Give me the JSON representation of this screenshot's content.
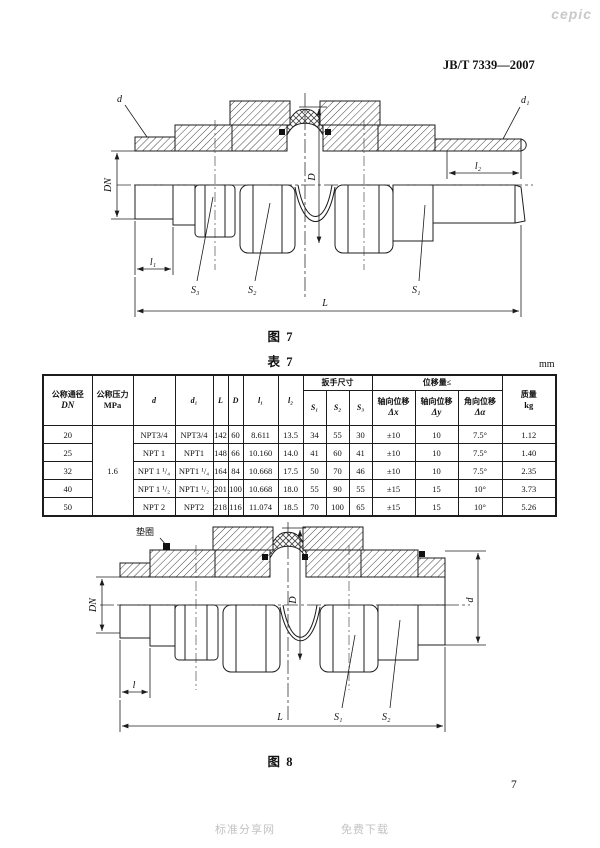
{
  "page": {
    "watermark": "cepic",
    "doc_number": "JB/T 7339—2007",
    "unit": "mm",
    "page_number": "7",
    "footer_left": "标准分享网",
    "footer_right": "免费下载"
  },
  "fig7": {
    "caption": "图  7",
    "labels": {
      "d": "d",
      "d1": "d₁",
      "dn": "DN",
      "D": "D",
      "l1": "l₁",
      "l2": "l₂",
      "s1": "S₁",
      "s2": "S₂",
      "s3": "S₃",
      "L": "L"
    }
  },
  "table7": {
    "caption": "表  7",
    "header": {
      "dn_zh": "公称通径",
      "dn_en": "DN",
      "pressure_zh": "公称压力",
      "pressure_en": "MPa",
      "d": "d",
      "d1": "d₁",
      "L": "L",
      "D": "D",
      "l1": "l₁",
      "l2": "l₂",
      "wrench_group": "扳手尺寸",
      "s1": "S₁",
      "s2": "S₂",
      "s3": "S₃",
      "disp_group": "位移量≤",
      "dx_zh": "轴向位移",
      "dx_sym": "Δx",
      "dy_zh": "轴向位移",
      "dy_sym": "Δy",
      "da_zh": "角向位移",
      "da_sym": "Δα",
      "mass_zh": "质量",
      "mass_en": "kg"
    },
    "pressure_value": "1.6",
    "rows": [
      {
        "dn": "20",
        "d": "NPT3/4",
        "d1": "NPT3/4",
        "L": "142",
        "D": "60",
        "l1": "8.611",
        "l2": "13.5",
        "s1": "34",
        "s2": "55",
        "s3": "30",
        "dx": "±10",
        "dy": "10",
        "da": "7.5°",
        "mass": "1.12"
      },
      {
        "dn": "25",
        "d": "NPT 1",
        "d1": "NPT1",
        "L": "148",
        "D": "66",
        "l1": "10.160",
        "l2": "14.0",
        "s1": "41",
        "s2": "60",
        "s3": "41",
        "dx": "±10",
        "dy": "10",
        "da": "7.5°",
        "mass": "1.40"
      },
      {
        "dn": "32",
        "d": "NPT 1 ¹/₄",
        "d1": "NPT1 ¹/₄",
        "L": "164",
        "D": "84",
        "l1": "10.668",
        "l2": "17.5",
        "s1": "50",
        "s2": "70",
        "s3": "46",
        "dx": "±10",
        "dy": "10",
        "da": "7.5°",
        "mass": "2.35"
      },
      {
        "dn": "40",
        "d": "NPT 1 ¹/₂",
        "d1": "NPT1 ¹/₂",
        "L": "201",
        "D": "100",
        "l1": "10.668",
        "l2": "18.0",
        "s1": "55",
        "s2": "90",
        "s3": "55",
        "dx": "±15",
        "dy": "15",
        "da": "10°",
        "mass": "3.73"
      },
      {
        "dn": "50",
        "d": "NPT 2",
        "d1": "NPT2",
        "L": "218",
        "D": "116",
        "l1": "11.074",
        "l2": "18.5",
        "s1": "70",
        "s2": "100",
        "s3": "65",
        "dx": "±15",
        "dy": "15",
        "da": "10°",
        "mass": "5.26"
      }
    ]
  },
  "fig8": {
    "caption": "图  8",
    "labels": {
      "gasket": "垫圈",
      "dn": "DN",
      "D": "D",
      "d": "d",
      "l": "l",
      "s1": "S₁",
      "s2": "S₂",
      "L": "L"
    }
  }
}
